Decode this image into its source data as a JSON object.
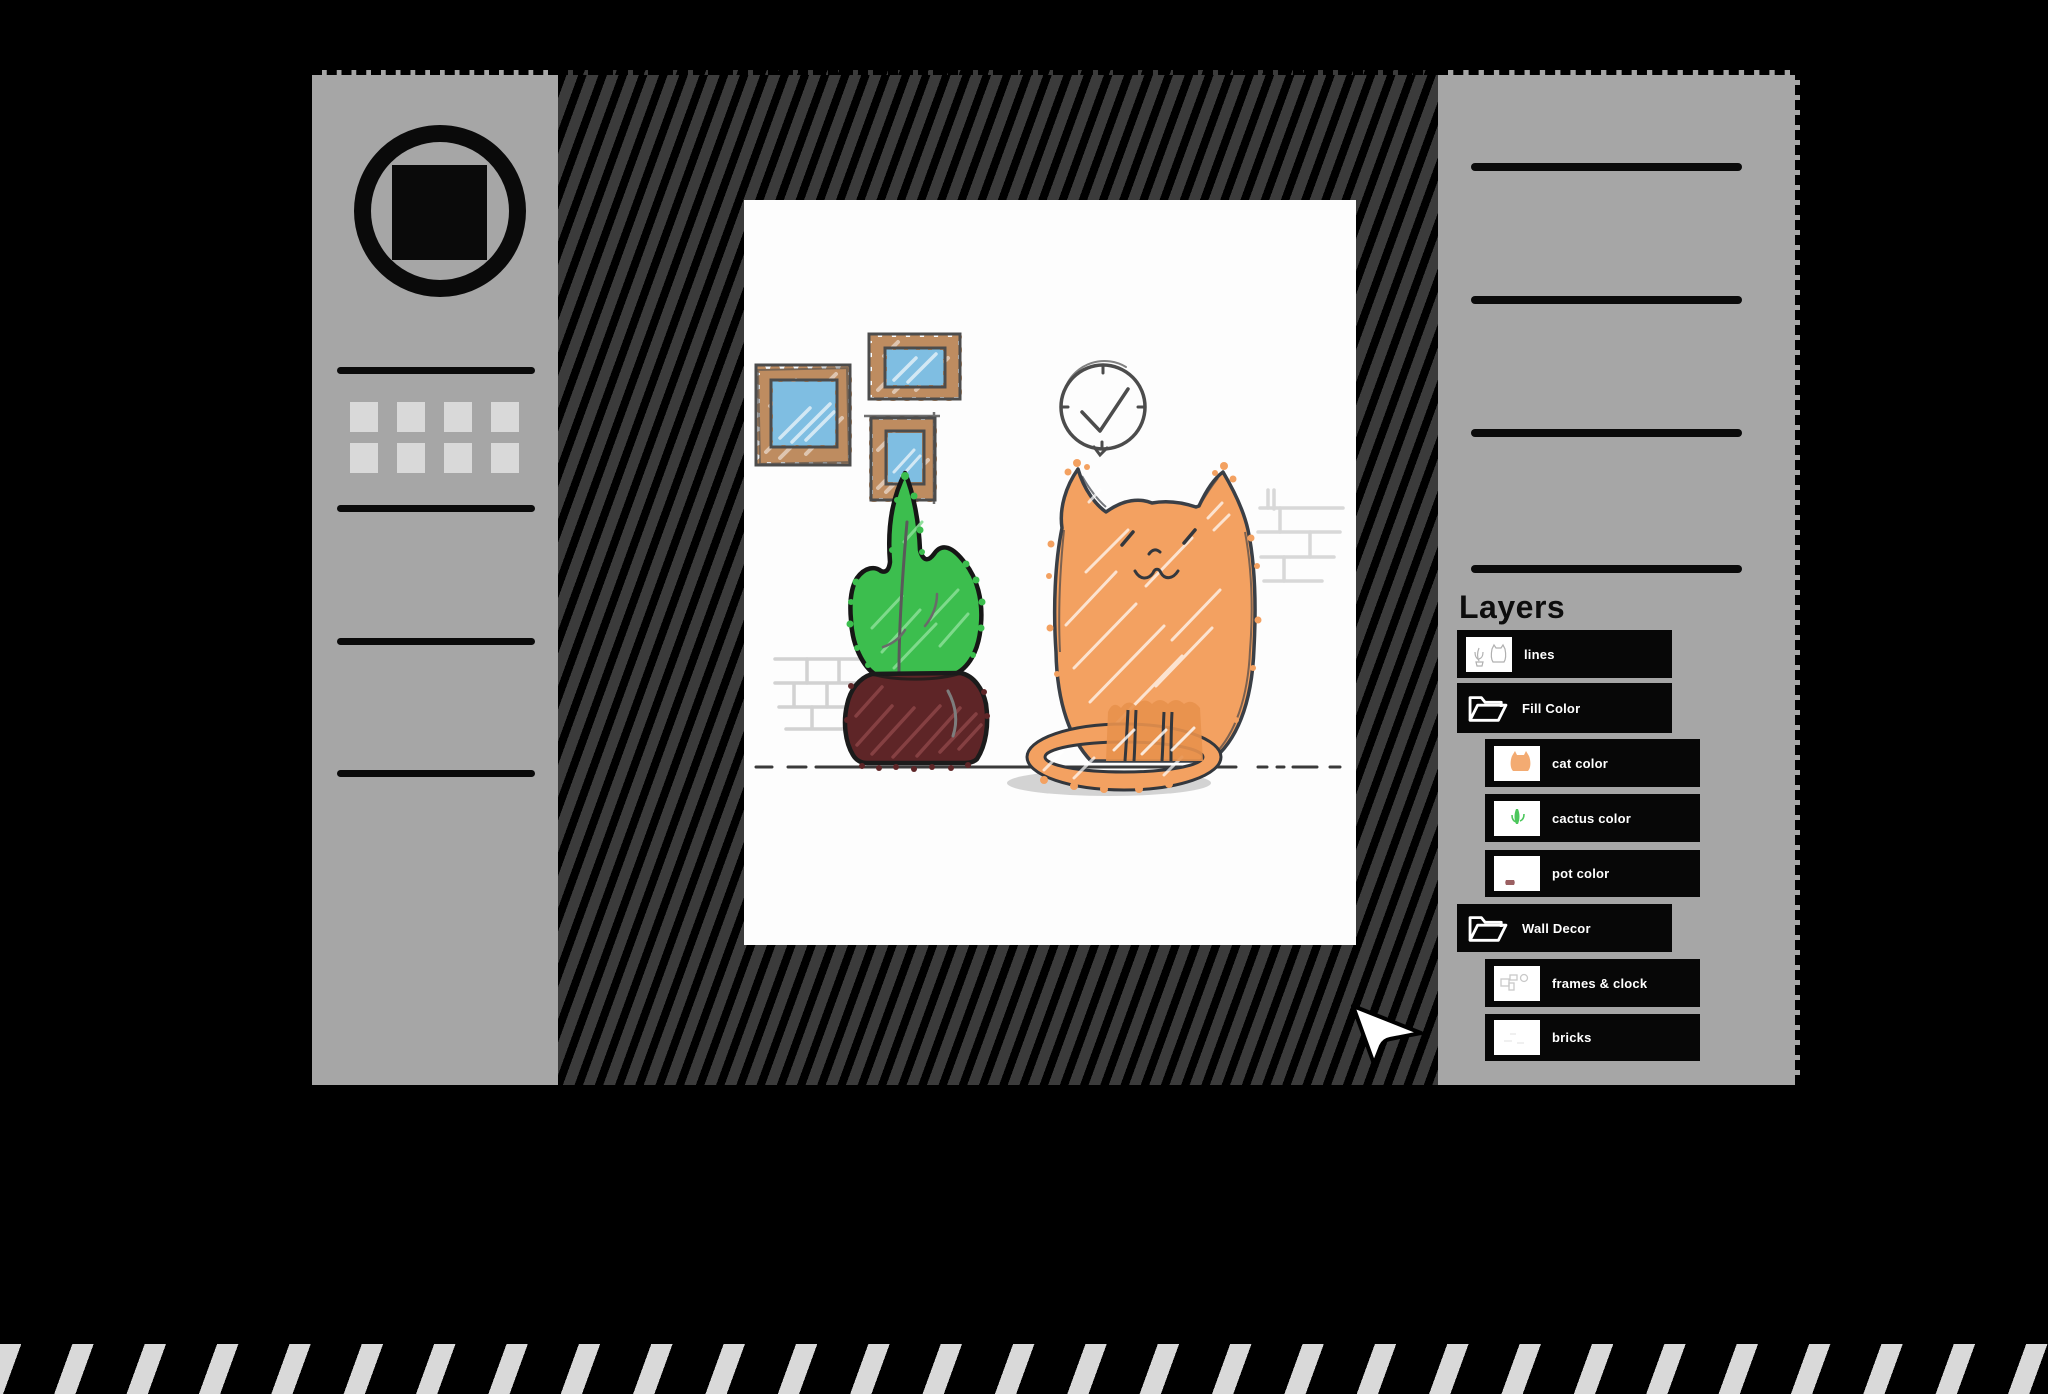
{
  "layers_panel": {
    "title": "Layers",
    "items": [
      {
        "label": "lines",
        "kind": "layer",
        "indent": 0,
        "thumb": "sketch-outlines-thumbnail"
      },
      {
        "label": "Fill Color",
        "kind": "group",
        "indent": 0,
        "icon": "open-folder-icon"
      },
      {
        "label": "cat color",
        "kind": "layer",
        "indent": 1,
        "thumb": "orange-cat-thumbnail"
      },
      {
        "label": "cactus color",
        "kind": "layer",
        "indent": 1,
        "thumb": "green-cactus-thumbnail"
      },
      {
        "label": "pot color",
        "kind": "layer",
        "indent": 1,
        "thumb": "maroon-pot-thumbnail"
      },
      {
        "label": "Wall Decor",
        "kind": "group",
        "indent": 0,
        "icon": "open-folder-icon"
      },
      {
        "label": "frames & clock",
        "kind": "layer",
        "indent": 1,
        "thumb": "frames-and-clock-thumbnail"
      },
      {
        "label": "bricks",
        "kind": "layer",
        "indent": 1,
        "thumb": "faint-bricks-thumbnail"
      }
    ]
  },
  "left_toolbar": {
    "logo": "circle-square-logo",
    "tool_slots": 8
  },
  "canvas_art": {
    "subjects": [
      "three picture frames",
      "wall clock",
      "cactus in pot",
      "orange cat",
      "brick sketches",
      "floor line"
    ],
    "colors": {
      "cat_orange": "#F3A161",
      "cactus_green": "#3CBE4E",
      "pot_maroon": "#5E2527",
      "frame_wood": "#BE8C60",
      "frame_glass": "#7FBEE2",
      "sketch_gray": "#4C4C4C"
    }
  },
  "theme": {
    "background": "#000000",
    "sidebar_gray": "#A6A6A6",
    "workspace_dark": "#3B3B3B",
    "layer_bar_black": "#070707",
    "canvas_white": "#FDFDFD",
    "stripe_light": "#D9D9D9"
  }
}
